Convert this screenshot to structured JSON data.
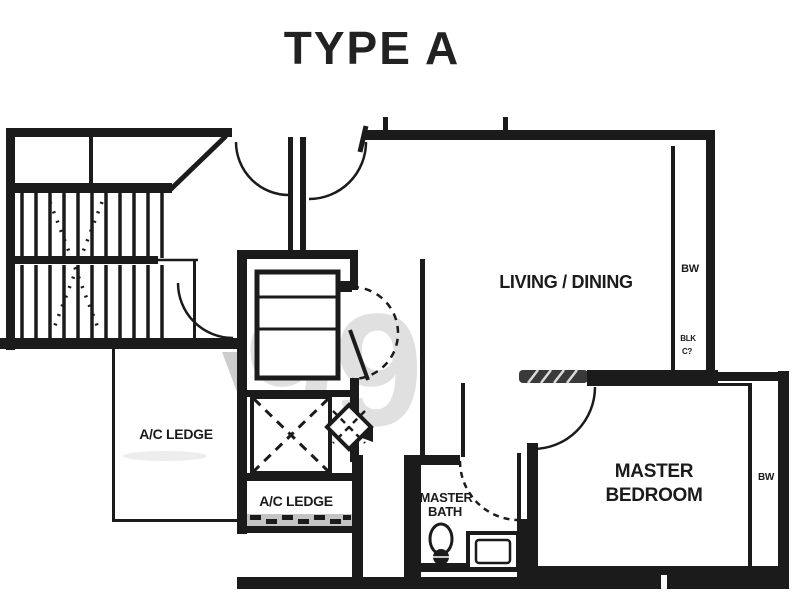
{
  "title": "TYPE A",
  "rooms": {
    "living_dining": {
      "label": "LIVING / DINING"
    },
    "master_bedroom": {
      "line1": "MASTER",
      "line2": "BEDROOM"
    },
    "master_bath": {
      "line1": "MASTER",
      "line2": "BATH"
    },
    "ac_ledge_left": {
      "label": "A/C LEDGE"
    },
    "ac_ledge_bottom": {
      "label": "A/C LEDGE"
    }
  },
  "annotations": {
    "bay_window_living": "BW",
    "bay_window_bedroom": "BW",
    "shaft_text_line1": "BLK",
    "shaft_text_line2": "C?"
  },
  "watermark": {
    "text": "99"
  },
  "colors": {
    "ink": "#1b1b1b",
    "background": "#ffffff",
    "watermark_gray": "#e0e0e0",
    "hatch_gray": "#c4c4c4"
  }
}
